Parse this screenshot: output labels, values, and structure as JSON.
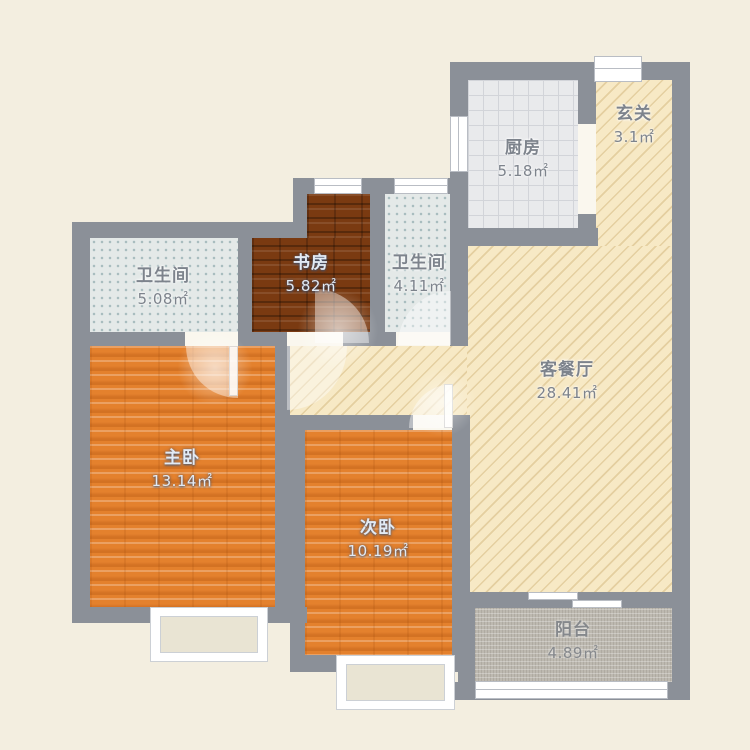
{
  "plan": {
    "type": "apartment-floor-plan",
    "rooms": [
      {
        "id": "entrance",
        "name": "玄关",
        "area": "3.1㎡"
      },
      {
        "id": "kitchen",
        "name": "厨房",
        "area": "5.18㎡"
      },
      {
        "id": "bathroom-left",
        "name": "卫生间",
        "area": "5.08㎡"
      },
      {
        "id": "study",
        "name": "书房",
        "area": "5.82㎡"
      },
      {
        "id": "bathroom-right",
        "name": "卫生间",
        "area": "4.11㎡"
      },
      {
        "id": "living-dining",
        "name": "客餐厅",
        "area": "28.41㎡"
      },
      {
        "id": "master-bedroom",
        "name": "主卧",
        "area": "13.14㎡"
      },
      {
        "id": "second-bedroom",
        "name": "次卧",
        "area": "10.19㎡"
      },
      {
        "id": "balcony",
        "name": "阳台",
        "area": "4.89㎡"
      }
    ],
    "colors": {
      "background": "#f3eee0",
      "wall": "#8b9098",
      "living_floor": "#f7e9c5",
      "kitchen_floor": "#e9eaec",
      "bathroom_floor": "#e4e9e8",
      "study_floor": "#7a3a11",
      "bedroom_floor": "#e4812d",
      "balcony_floor": "#bdb9b0",
      "window": "#ffffff"
    }
  }
}
